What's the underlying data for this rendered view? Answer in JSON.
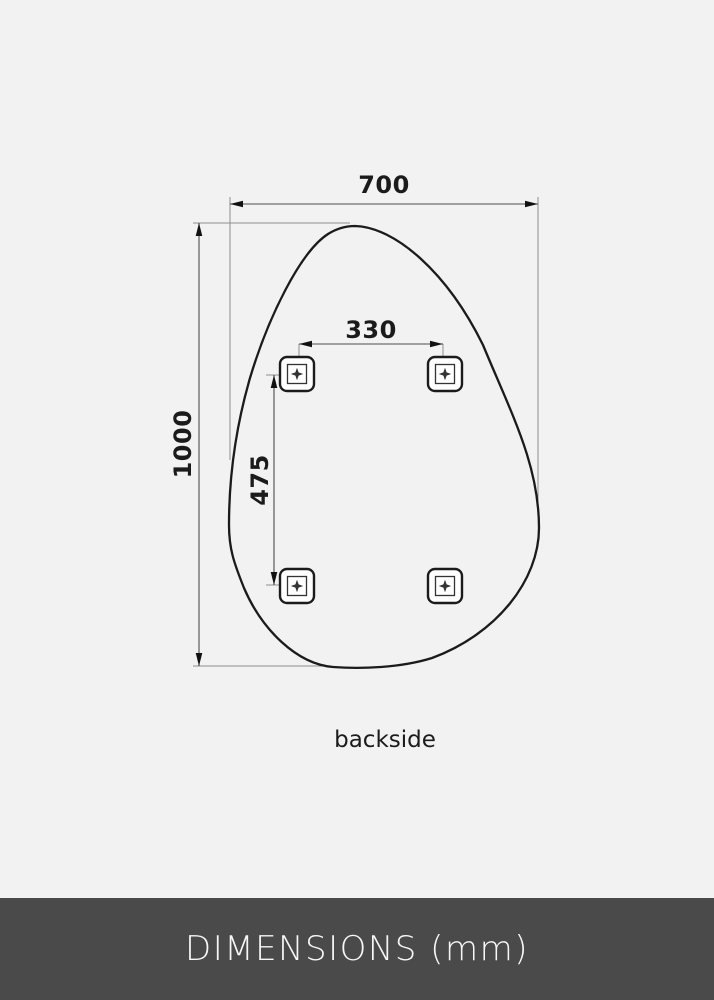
{
  "diagram": {
    "caption": "backside",
    "dimensions": {
      "overall_width": "700",
      "overall_height": "1000",
      "mount_spacing_horizontal": "330",
      "mount_spacing_vertical": "475"
    }
  },
  "footer": {
    "label": "DIMENSIONS (mm)"
  },
  "colors": {
    "background": "#f2f2f2",
    "outline": "#1b1b1b",
    "footer_background": "#4a4a4a",
    "footer_text": "#f7f7f7"
  }
}
